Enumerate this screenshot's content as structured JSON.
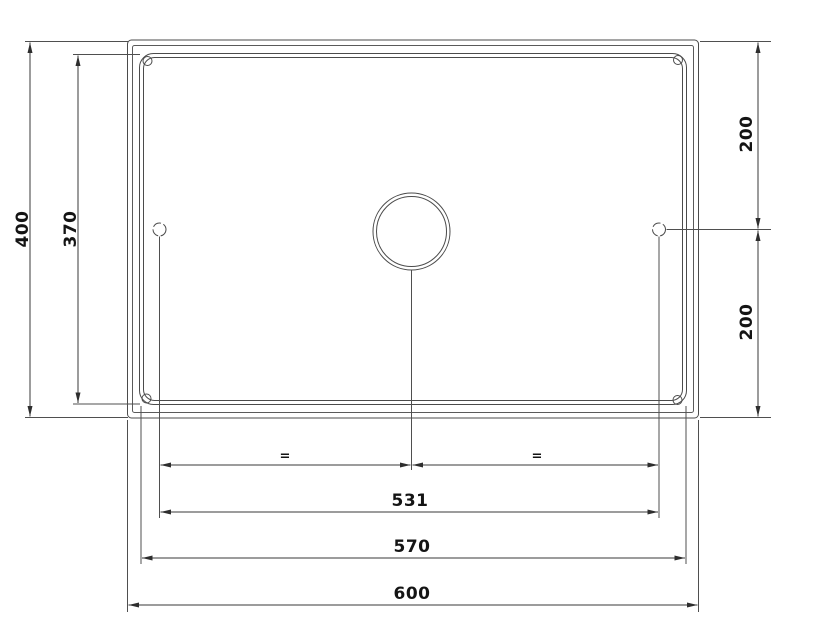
{
  "colors": {
    "background": "#ffffff",
    "geometry_line": "#4b4b4b",
    "dimension_line": "#383838",
    "text": "#141414"
  },
  "dims": {
    "overall_width": "600",
    "bowl_width": "570",
    "hole_spacing": "531",
    "overall_depth": "400",
    "bowl_depth": "370",
    "center_to_top": "200",
    "center_to_bottom": "200",
    "equal_left": "=",
    "equal_right": "="
  }
}
